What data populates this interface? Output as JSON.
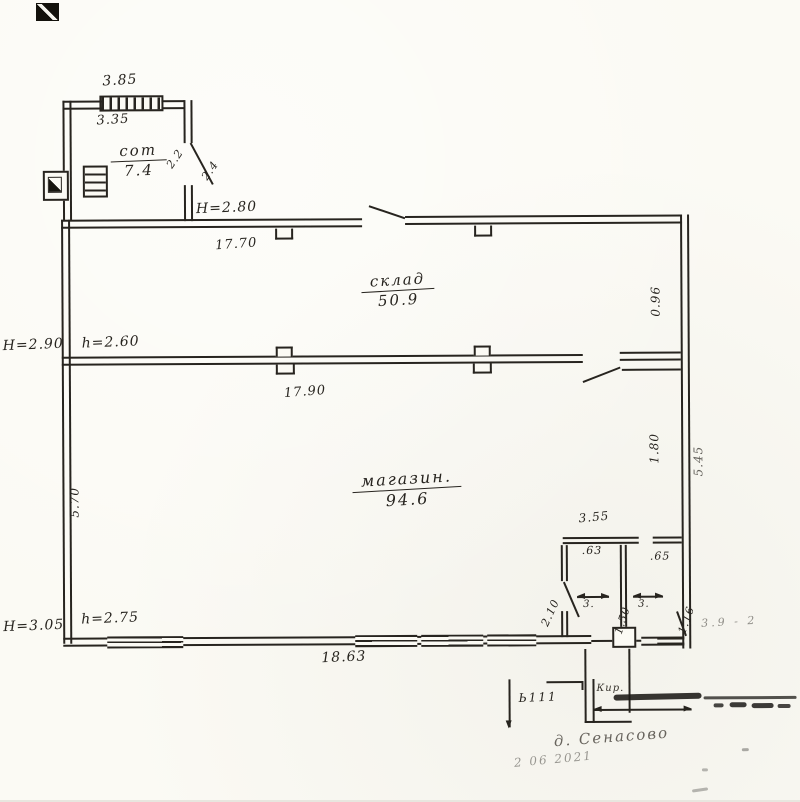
{
  "rooms": [
    {
      "key": "sot",
      "name": "сот",
      "area": "7.4"
    },
    {
      "key": "sklad",
      "name": "склад",
      "area": "50.9"
    },
    {
      "key": "magazin",
      "name": "магазин.",
      "area": "94.6"
    }
  ],
  "dims": {
    "d385": "3.85",
    "d335": "3.35",
    "H280": "H=2.80",
    "d1770": "17.70",
    "H290": "H=2.90",
    "h260": "h=2.60",
    "d1790": "17.90",
    "d570": "5.70",
    "d096": "0.96",
    "d180": "1.80",
    "d545": "5.45",
    "H305": "H=3.05",
    "h275": "h=2.75",
    "d1863": "18.63",
    "d355": "3.55",
    "d63": ".63",
    "d65": ".65",
    "d210": "2.10",
    "d150": "1.50",
    "d116": "1.16",
    "m3a": "3.",
    "m3b": "3.",
    "door22": "2.2",
    "door24": "2.4",
    "faint39": "3.9 - 2"
  },
  "stamp": {
    "code": "Ь111",
    "kir": "Кир.",
    "hw1": "д. Сенасово",
    "hw2": "2 06 2021"
  }
}
